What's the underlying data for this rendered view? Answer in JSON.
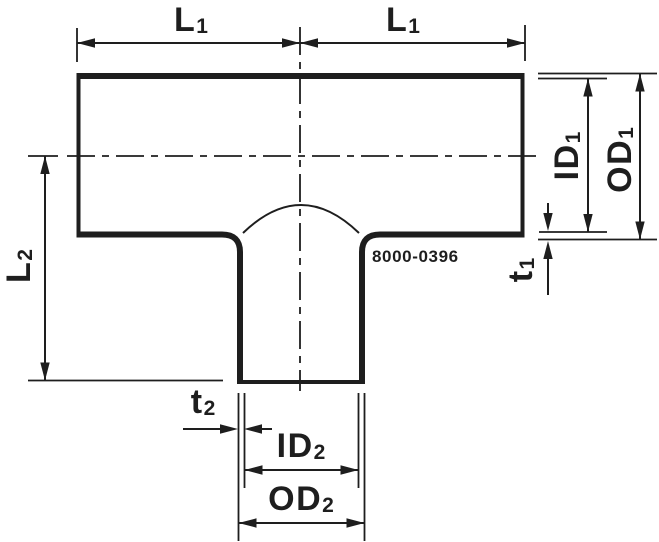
{
  "drawing": {
    "part_number": "8000-0396",
    "labels": {
      "l1_left": {
        "main": "L",
        "sub": "1"
      },
      "l1_right": {
        "main": "L",
        "sub": "1"
      },
      "l2": {
        "main": "L",
        "sub": "2"
      },
      "id1": {
        "main": "ID",
        "sub": "1"
      },
      "od1": {
        "main": "OD",
        "sub": "1"
      },
      "t1": {
        "main": "t",
        "sub": "1"
      },
      "t2": {
        "main": "t",
        "sub": "2"
      },
      "id2": {
        "main": "ID",
        "sub": "2"
      },
      "od2": {
        "main": "OD",
        "sub": "2"
      }
    },
    "colors": {
      "line": "#1e1e1e",
      "background": "#ffffff"
    }
  }
}
